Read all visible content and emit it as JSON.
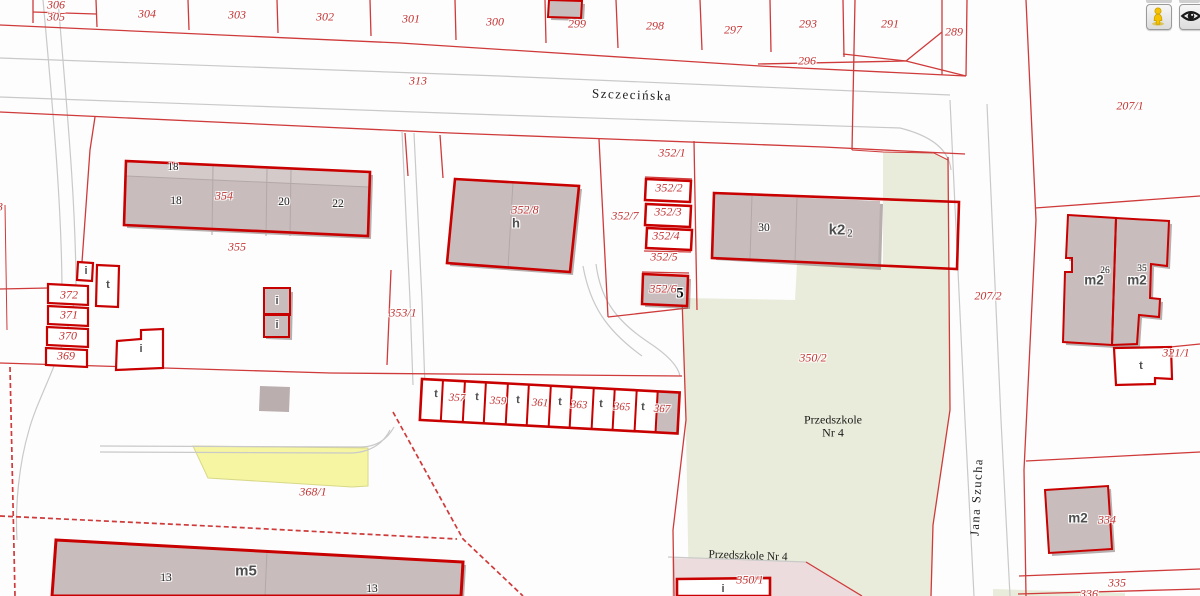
{
  "colors": {
    "parcel_line": "#cf3a3a",
    "building_outline": "#c80000",
    "building_fill": "#c9bcbc",
    "label_red": "#c43434",
    "green_area": "#e9ecda",
    "pink_area": "#ecdcdd",
    "yellow_area": "#f6f6a2",
    "pegman_yellow": "#f6c100"
  },
  "controls": {
    "buttons": [
      {
        "name": "street-view-button",
        "icon": "pegman-icon"
      },
      {
        "name": "visibility-button",
        "icon": "eye-icon"
      }
    ]
  },
  "map": {
    "street_names": [
      "Szczecińska",
      "Jana Szucha"
    ],
    "place_names": [
      "Przedszkole Nr 4"
    ],
    "labels": [
      {
        "text": "306",
        "x": 56,
        "y": 5,
        "cls": "parcel",
        "name": "parcel-label-306"
      },
      {
        "text": "305",
        "x": 56,
        "y": 17,
        "cls": "parcel",
        "name": "parcel-label-305"
      },
      {
        "text": "304",
        "x": 147,
        "y": 14,
        "cls": "parcel",
        "name": "parcel-label-304"
      },
      {
        "text": "303",
        "x": 237,
        "y": 15,
        "cls": "parcel",
        "name": "parcel-label-303"
      },
      {
        "text": "302",
        "x": 325,
        "y": 17,
        "cls": "parcel",
        "name": "parcel-label-302"
      },
      {
        "text": "301",
        "x": 411,
        "y": 19,
        "cls": "parcel",
        "name": "parcel-label-301"
      },
      {
        "text": "300",
        "x": 495,
        "y": 22,
        "cls": "parcel",
        "name": "parcel-label-300"
      },
      {
        "text": "299",
        "x": 577,
        "y": 24,
        "cls": "parcel",
        "name": "parcel-label-299"
      },
      {
        "text": "298",
        "x": 655,
        "y": 26,
        "cls": "parcel",
        "name": "parcel-label-298"
      },
      {
        "text": "297",
        "x": 733,
        "y": 30,
        "cls": "parcel",
        "name": "parcel-label-297"
      },
      {
        "text": "293",
        "x": 808,
        "y": 24,
        "cls": "parcel",
        "name": "parcel-label-293"
      },
      {
        "text": "291",
        "x": 890,
        "y": 24,
        "cls": "parcel",
        "name": "parcel-label-291"
      },
      {
        "text": "289",
        "x": 954,
        "y": 32,
        "cls": "parcel",
        "name": "parcel-label-289"
      },
      {
        "text": "296",
        "x": 807,
        "y": 61,
        "cls": "parcel",
        "name": "parcel-label-296"
      },
      {
        "text": "313",
        "x": 418,
        "y": 81,
        "cls": "parcel",
        "name": "parcel-label-313"
      },
      {
        "text": "207/1",
        "x": 1130,
        "y": 106,
        "cls": "parcel",
        "name": "parcel-label-207-1"
      },
      {
        "text": "3",
        "x": 0,
        "y": 207,
        "cls": "parcel",
        "name": "parcel-label-3-clipped"
      },
      {
        "text": "352/1",
        "x": 672,
        "y": 153,
        "cls": "parcel",
        "name": "parcel-label-352-1"
      },
      {
        "text": "352/2",
        "x": 669,
        "y": 188,
        "cls": "parcel",
        "name": "parcel-label-352-2"
      },
      {
        "text": "352/3",
        "x": 668,
        "y": 212,
        "cls": "parcel",
        "name": "parcel-label-352-3"
      },
      {
        "text": "352/4",
        "x": 666,
        "y": 236,
        "cls": "parcel",
        "name": "parcel-label-352-4"
      },
      {
        "text": "352/5",
        "x": 664,
        "y": 257,
        "cls": "parcel",
        "name": "parcel-label-352-5"
      },
      {
        "text": "352/6",
        "x": 663,
        "y": 289,
        "cls": "parcel",
        "name": "parcel-label-352-6"
      },
      {
        "text": "352/7",
        "x": 625,
        "y": 216,
        "cls": "parcel",
        "name": "parcel-label-352-7"
      },
      {
        "text": "352/8",
        "x": 525,
        "y": 210,
        "cls": "parcel",
        "name": "parcel-label-352-8"
      },
      {
        "text": "353/1",
        "x": 403,
        "y": 313,
        "cls": "parcel",
        "name": "parcel-label-353-1"
      },
      {
        "text": "354",
        "x": 224,
        "y": 196,
        "cls": "parcel",
        "name": "parcel-label-354"
      },
      {
        "text": "355",
        "x": 237,
        "y": 247,
        "cls": "parcel",
        "name": "parcel-label-355"
      },
      {
        "text": "372",
        "x": 69,
        "y": 295,
        "cls": "parcel",
        "name": "parcel-label-372"
      },
      {
        "text": "371",
        "x": 69,
        "y": 315,
        "cls": "parcel",
        "name": "parcel-label-371"
      },
      {
        "text": "370",
        "x": 68,
        "y": 336,
        "cls": "parcel",
        "name": "parcel-label-370"
      },
      {
        "text": "369",
        "x": 66,
        "y": 356,
        "cls": "parcel",
        "name": "parcel-label-369"
      },
      {
        "text": "350/2",
        "x": 813,
        "y": 358,
        "cls": "parcel",
        "name": "parcel-label-350-2"
      },
      {
        "text": "350/1",
        "x": 750,
        "y": 580,
        "cls": "parcel",
        "name": "parcel-label-350-1"
      },
      {
        "text": "368/1",
        "x": 313,
        "y": 492,
        "cls": "parcel",
        "name": "parcel-label-368-1"
      },
      {
        "text": "357",
        "x": 457,
        "y": 398,
        "cls": "parcel",
        "size": 11,
        "rot": 3,
        "name": "parcel-label-357"
      },
      {
        "text": "359",
        "x": 498,
        "y": 401,
        "cls": "parcel",
        "size": 11,
        "rot": 3,
        "name": "parcel-label-359"
      },
      {
        "text": "361",
        "x": 540,
        "y": 403,
        "cls": "parcel",
        "size": 11,
        "rot": 3,
        "name": "parcel-label-361"
      },
      {
        "text": "363",
        "x": 579,
        "y": 405,
        "cls": "parcel",
        "size": 11,
        "rot": 3,
        "name": "parcel-label-363"
      },
      {
        "text": "365",
        "x": 622,
        "y": 407,
        "cls": "parcel",
        "size": 11,
        "rot": 3,
        "name": "parcel-label-365"
      },
      {
        "text": "367",
        "x": 662,
        "y": 409,
        "cls": "parcel",
        "size": 11,
        "rot": 3,
        "name": "parcel-label-367"
      },
      {
        "text": "207/2",
        "x": 988,
        "y": 296,
        "cls": "parcel",
        "name": "parcel-label-207-2"
      },
      {
        "text": "321/1",
        "x": 1176,
        "y": 353,
        "cls": "parcel",
        "name": "parcel-label-321-1"
      },
      {
        "text": "334",
        "x": 1107,
        "y": 520,
        "cls": "parcel",
        "name": "parcel-label-334"
      },
      {
        "text": "335",
        "x": 1117,
        "y": 583,
        "cls": "parcel",
        "name": "parcel-label-335"
      },
      {
        "text": "336",
        "x": 1089,
        "y": 594,
        "cls": "parcel",
        "name": "parcel-label-336"
      },
      {
        "text": "18",
        "x": 173,
        "y": 167,
        "cls": "addr",
        "size": 11,
        "name": "building-number-18-upper"
      },
      {
        "text": "18",
        "x": 176,
        "y": 201,
        "cls": "addr",
        "name": "building-number-18"
      },
      {
        "text": "20",
        "x": 284,
        "y": 202,
        "cls": "addr",
        "name": "building-number-20"
      },
      {
        "text": "22",
        "x": 338,
        "y": 204,
        "cls": "addr",
        "name": "building-number-22"
      },
      {
        "text": "30",
        "x": 764,
        "y": 228,
        "cls": "addr",
        "name": "building-number-30"
      },
      {
        "text": "13",
        "x": 166,
        "y": 578,
        "cls": "addr",
        "name": "building-number-13a"
      },
      {
        "text": "13",
        "x": 372,
        "y": 589,
        "cls": "addr",
        "name": "building-number-13b"
      },
      {
        "text": "26",
        "x": 1105,
        "y": 271,
        "cls": "addr",
        "size": 9.5,
        "name": "building-number-26"
      },
      {
        "text": "35",
        "x": 1142,
        "y": 269,
        "cls": "addr",
        "size": 9.5,
        "name": "building-number-35"
      },
      {
        "text": "2",
        "x": 850,
        "y": 234,
        "cls": "addr",
        "size": 10,
        "name": "building-number-2"
      },
      {
        "text": "5",
        "x": 680,
        "y": 294,
        "cls": "addr-lg",
        "name": "building-number-5"
      },
      {
        "text": "h",
        "x": 516,
        "y": 223,
        "cls": "btype",
        "size": 13,
        "name": "building-type-h"
      },
      {
        "text": "k2",
        "x": 837,
        "y": 230,
        "cls": "btype",
        "size": 15,
        "name": "building-type-k2"
      },
      {
        "text": "m5",
        "x": 246,
        "y": 571,
        "cls": "btype",
        "size": 15,
        "name": "building-type-m5"
      },
      {
        "text": "m2",
        "x": 1094,
        "y": 280,
        "cls": "btype",
        "size": 13.5,
        "name": "building-type-m2-1"
      },
      {
        "text": "m2",
        "x": 1137,
        "y": 280,
        "cls": "btype",
        "size": 13.5,
        "name": "building-type-m2-2"
      },
      {
        "text": "m2",
        "x": 1078,
        "y": 518,
        "cls": "btype",
        "size": 13.5,
        "name": "building-type-m2-3"
      },
      {
        "text": "i",
        "x": 86,
        "y": 271,
        "cls": "btype",
        "name": "building-type-i-1"
      },
      {
        "text": "i",
        "x": 277,
        "y": 301,
        "cls": "btype",
        "name": "building-type-i-2"
      },
      {
        "text": "i",
        "x": 277,
        "y": 325,
        "cls": "btype",
        "name": "building-type-i-3"
      },
      {
        "text": "i",
        "x": 141,
        "y": 349,
        "cls": "btype",
        "name": "building-type-i-4"
      },
      {
        "text": "i",
        "x": 723,
        "y": 589,
        "cls": "btype",
        "name": "building-type-i-5"
      },
      {
        "text": "t",
        "x": 108,
        "y": 285,
        "cls": "btype",
        "name": "building-type-t-1"
      },
      {
        "text": "t",
        "x": 1141,
        "y": 366,
        "cls": "btype",
        "name": "building-type-t-2"
      },
      {
        "text": "t",
        "x": 436,
        "y": 394,
        "cls": "btype",
        "rot": 3,
        "name": "building-type-t-3"
      },
      {
        "text": "t",
        "x": 477,
        "y": 397,
        "cls": "btype",
        "rot": 3,
        "name": "building-type-t-4"
      },
      {
        "text": "t",
        "x": 518,
        "y": 400,
        "cls": "btype",
        "rot": 3,
        "name": "building-type-t-5"
      },
      {
        "text": "t",
        "x": 560,
        "y": 402,
        "cls": "btype",
        "rot": 3,
        "name": "building-type-t-6"
      },
      {
        "text": "t",
        "x": 601,
        "y": 404,
        "cls": "btype",
        "rot": 3,
        "name": "building-type-t-7"
      },
      {
        "text": "t",
        "x": 643,
        "y": 407,
        "cls": "btype",
        "rot": 3,
        "name": "building-type-t-8"
      },
      {
        "text": "Szczecińska",
        "x": 632,
        "y": 95,
        "cls": "street",
        "rot": 2,
        "name": "street-label-szczecinska"
      },
      {
        "text": "Jana Szucha",
        "x": 977,
        "y": 497,
        "cls": "street",
        "size": 12.5,
        "rot": -87,
        "name": "street-label-jana-szucha"
      },
      {
        "text": "Przedszkole",
        "x": 833,
        "y": 420,
        "cls": "place",
        "name": "place-label-przedszkole-line1"
      },
      {
        "text": "Nr 4",
        "x": 833,
        "y": 433,
        "cls": "place",
        "name": "place-label-przedszkole-line2"
      },
      {
        "text": "Przedszkole Nr 4",
        "x": 748,
        "y": 556,
        "cls": "place",
        "size": 11.5,
        "rot": 2,
        "name": "place-label-przedszkole-south"
      }
    ]
  }
}
